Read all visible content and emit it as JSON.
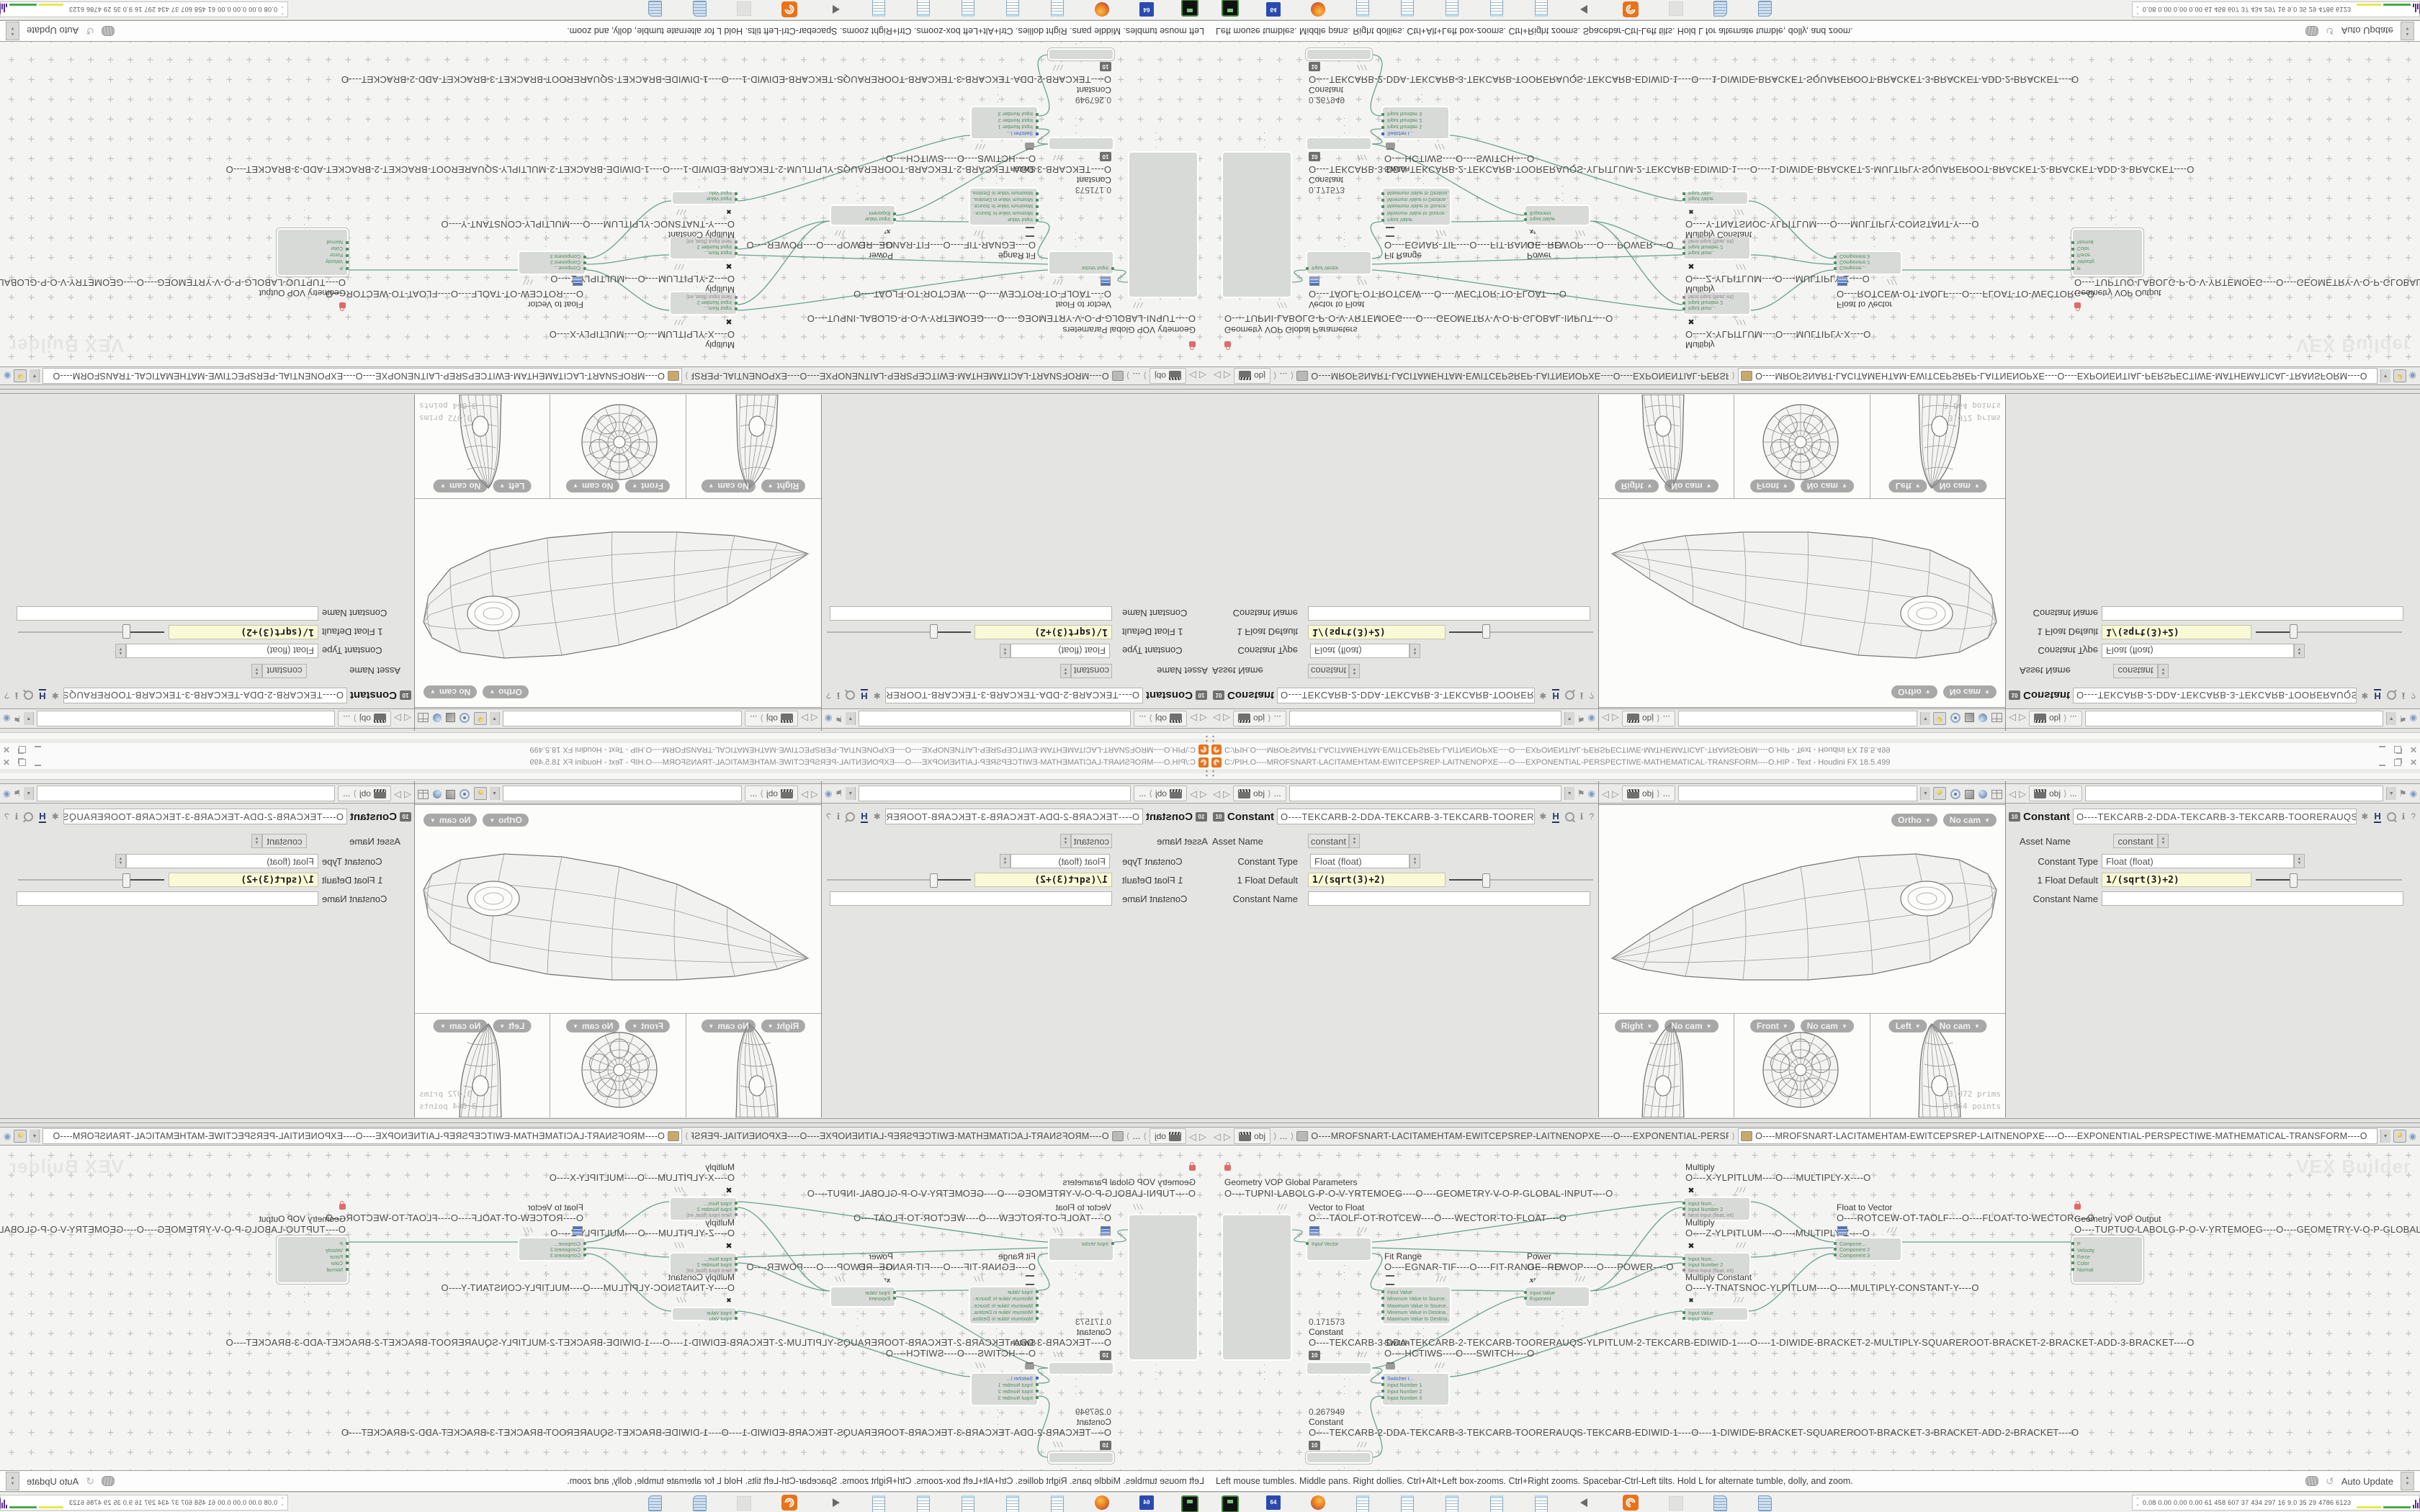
{
  "app": {
    "title": "C:/PIH.O----MROFSNART-LACITAMEHTAM-EWITCEPSREP-LAITNENOPXE----O----EXPONENTIAL-PERSPECTIWE-MATHEMATICAL-TRANSFORM----O.HIP - Text - Houdini FX 18.5.499",
    "accent_color": "#e8731a",
    "window_controls": [
      "minimize",
      "restore",
      "close"
    ]
  },
  "pane_bar": {
    "context": "obj",
    "ellipsis": "..."
  },
  "param_pane": {
    "type_label": "Constant",
    "node_name": "O----TEKCARB-2-DDA-TEKCARB-3-TEKCARB-TOORERAUQS-TEKCA",
    "rows": [
      {
        "label": "Asset Name",
        "value": "constant"
      },
      {
        "label": "Constant Type",
        "value": "Float (float)"
      },
      {
        "label": "1 Float Default",
        "value": "1/(sqrt(3)+2)"
      },
      {
        "label": "Constant Name",
        "value": ""
      }
    ]
  },
  "viewport": {
    "main_view": {
      "view": "Ortho",
      "camera": "No cam"
    },
    "small_views": [
      {
        "view": "Right",
        "camera": "No cam"
      },
      {
        "view": "Front",
        "camera": "No cam"
      },
      {
        "view": "Left",
        "camera": "No cam"
      }
    ],
    "stats": {
      "prims": "3,072 prims",
      "points": "3,064 points"
    }
  },
  "network": {
    "context_label": "obj",
    "context_name": "O----MROFSNART-LACITAMEHTAM-EWITCEPSREP-LAITNENOPXE----O----EXPONENTIAL-PERSPECTIWE-MATHEMATICAL-TRANSFORM----O",
    "watermark": "VEX Builder",
    "wire_color": "#68a18c",
    "port_colors": {
      "g": "#4e8f5e",
      "b": "#3a62c8",
      "n": "#9a7a42",
      "x": "#8a8a8a"
    },
    "nodes": [
      {
        "id": "globalparams",
        "stack": "tall",
        "lock": true,
        "label": "Geometry VOP Global Parameters",
        "name": "O----TUPNI-LABOLG-P-O-V-YRTEMOEG----O----GEOMETRY-V-O-P-GLOBAL-INPUT----O",
        "box": [
          18,
          97,
          94,
          200
        ],
        "ps": 20,
        "pstep": 8.3,
        "outputs": [
          [
            "P",
            "g"
          ],
          [
            "Velocity",
            "g"
          ],
          [
            "Force",
            "g"
          ],
          [
            "Age",
            "g"
          ],
          [
            "Life",
            "g"
          ],
          [
            "Id",
            "b"
          ],
          [
            "Cd",
            "g"
          ],
          [
            "UV",
            "g"
          ],
          [
            "N",
            "g"
          ],
          [
            "Time",
            "g"
          ],
          [
            "Time Inc",
            "g"
          ],
          [
            "Frame",
            "g"
          ],
          [
            "Point Number",
            "g"
          ],
          [
            "Primitive Number",
            "g"
          ],
          [
            "Vertex Number",
            "g"
          ],
          [
            "Number of Points",
            "g"
          ],
          [
            "Number of Prims",
            "g"
          ],
          [
            "Number of Vertices",
            "g"
          ],
          [
            "First Input",
            "n"
          ],
          [
            "Second Input",
            "n"
          ],
          [
            "Third Input",
            "n"
          ],
          [
            "Fourth Input",
            "n"
          ]
        ]
      },
      {
        "id": "vectofloat",
        "icon": "vec",
        "label": "Vector to Float",
        "name": "O----TAOLF-OT-ROTCEW----O----WECTOR-TO-FLOAT----O",
        "box": [
          135,
          129,
          88,
          30
        ],
        "ps": 5,
        "pstep": 8,
        "inputs": [
          [
            "Input Vector",
            "g"
          ]
        ],
        "outputs": [
          [
            "Compone...",
            "g"
          ],
          [
            "Component 2",
            "g"
          ],
          [
            "Component 3",
            "g"
          ]
        ]
      },
      {
        "id": "fitrange",
        "icon": "fit",
        "label": "Fit Range",
        "name": "O----EGNAR-TIF----O----FIT-RANGE----O",
        "box": [
          240,
          197,
          93,
          50
        ],
        "ps": 4,
        "pstep": 9.3,
        "inputs": [
          [
            "Input Value",
            "g"
          ],
          [
            "Minimum Value In Source..",
            "g"
          ],
          [
            "Maximum Value In Source..",
            "g"
          ],
          [
            "Minimum Value in Destina..",
            "g"
          ],
          [
            "Maximum Value In Destina..",
            "g"
          ]
        ],
        "outputs": [
          [
            "Shifted Value",
            "g"
          ]
        ]
      },
      {
        "id": "power",
        "icon": "pow",
        "label": "Power",
        "name": "O----REWOP----O----POWER----O",
        "box": [
          438,
          197,
          88,
          26
        ],
        "ps": 5,
        "pstep": 8,
        "inputs": [
          [
            "Input Value",
            "g"
          ],
          [
            "Exponent",
            "g"
          ]
        ],
        "outputs": [
          [
            "Output Value",
            "g"
          ]
        ]
      },
      {
        "id": "multiplyx",
        "icon": "mul",
        "label": "Multiply",
        "name": "O----X-YLPITLUM----O----MULTIPLY-X----O",
        "box": [
          658,
          73,
          91,
          30
        ],
        "ps": 5,
        "pstep": 8,
        "inputs": [
          [
            "Input Num...",
            "g"
          ],
          [
            "Input Number 2",
            "g"
          ],
          [
            "Next Input (float, int)",
            "x"
          ]
        ],
        "outputs": [
          [
            "Combined...",
            "g"
          ]
        ]
      },
      {
        "id": "multiplyz",
        "icon": "mul",
        "label": "Multiply",
        "name": "O----Z-YLPITLUM----O----MULTIPLY-Z----O",
        "box": [
          658,
          150,
          91,
          30
        ],
        "ps": 5,
        "pstep": 8,
        "inputs": [
          [
            "Input Num...",
            "g"
          ],
          [
            "Input Number 2",
            "g"
          ],
          [
            "Next Input (float, int)",
            "x"
          ]
        ],
        "outputs": [
          [
            "Combined...",
            "g"
          ]
        ]
      },
      {
        "id": "multiplyconstant",
        "icon": "mulc",
        "label": "Multiply Constant",
        "name": "O----Y-TNATSNOC-YLPITLUM----O----MULTIPLY-CONSTANT-Y----O",
        "box": [
          658,
          226,
          88,
          16
        ],
        "ps": 4,
        "pstep": 7.5,
        "inputs": [
          [
            "Input Value",
            "g"
          ],
          [
            "Input Valu...",
            "g"
          ]
        ],
        "outputs": [
          [
            "",
            "g"
          ]
        ]
      },
      {
        "id": "floattovec",
        "icon": "vec",
        "label": "Float to Vector",
        "name": "O----ROTCEW-OT-TAOLF----O----FLOAT-TO-WECTOR----O",
        "box": [
          868,
          129,
          91,
          30
        ],
        "ps": 5,
        "pstep": 8,
        "inputs": [
          [
            "Compone...",
            "g"
          ],
          [
            "Component 2",
            "g"
          ],
          [
            "Component 3",
            "g"
          ]
        ],
        "outputs": [
          [
            "Output Ve...",
            "g"
          ]
        ]
      },
      {
        "id": "globaloutput",
        "stack": "compact",
        "lock": true,
        "label": "Geometry VOP Output",
        "name": "O----TUPTUO-LABOLG-P-O-V-YRTEMOEG----O----GEOMETRY-V-O-P-GLOBAL-OUTPUT----O",
        "box": [
          1198,
          127,
          96,
          63
        ],
        "ps": 7,
        "pstep": 9,
        "sel": true,
        "inputs": [
          [
            "P",
            "g"
          ],
          [
            "Velocity",
            "g"
          ],
          [
            "Force",
            "g"
          ],
          [
            "Color",
            "g"
          ],
          [
            "Normal",
            "g"
          ]
        ]
      },
      {
        "id": "constant1",
        "icon": "c10",
        "label": "Constant",
        "value": "0.171573",
        "name": "O----TEKCARB-3-DDA-TEKCARB-2-TEKCARB-TOORERAUQS-YLPITLUM-2-TEKCARB-EDIWID-1----O----1-DIWIDE-BRACKET-2-MULTIPLY-SQUAREROOT-BRACKET-2-BRACKET-ADD-3-BRACKET----O",
        "box": [
          135,
          302,
          88,
          15
        ],
        "ps": 4,
        "pstep": 8,
        "outvalue": ": 0.171573"
      },
      {
        "id": "switch",
        "icon": "sw",
        "label": "Switch",
        "name": "O----HCTIWS----O----SWITCH----O",
        "box": [
          240,
          317,
          91,
          43
        ],
        "ps": 4,
        "pstep": 9,
        "inputs": [
          [
            "Switcher I...",
            "b"
          ],
          [
            "Input Number 1",
            "g"
          ],
          [
            "Input Number 2",
            "g"
          ],
          [
            "Input Number 3",
            "g"
          ]
        ],
        "outputs": [
          [
            "Chosen Val...",
            "g"
          ]
        ]
      },
      {
        "id": "constant2",
        "icon": "c10",
        "label": "Constant",
        "value": "0.267949",
        "sel": true,
        "name": "O----TEKCARB-2-DDA-TEKCARB-3-TEKCARB-TOORERAUQS-TEKCARB-EDIWID-1----O----1-DIWIDE-BRACKET-SQUAREROOT-BRACKET-3-BRACKET-ADD-2-BRACKET----O",
        "box": [
          135,
          427,
          88,
          13
        ],
        "ps": 3,
        "pstep": 8,
        "outvalue": ": 0.267949"
      }
    ],
    "wires": [
      [
        112,
        117,
        133,
        134
      ],
      [
        224,
        134,
        656,
        78
      ],
      [
        224,
        142,
        656,
        155
      ],
      [
        224,
        150,
        238,
        201
      ],
      [
        333,
        201,
        436,
        202
      ],
      [
        527,
        202,
        656,
        86
      ],
      [
        527,
        202,
        656,
        163
      ],
      [
        224,
        309,
        238,
        330
      ],
      [
        224,
        309,
        436,
        210
      ],
      [
        224,
        433,
        238,
        348
      ],
      [
        333,
        321,
        656,
        230
      ],
      [
        749,
        78,
        866,
        134
      ],
      [
        749,
        155,
        866,
        142
      ],
      [
        747,
        230,
        866,
        150
      ],
      [
        960,
        134,
        1196,
        134
      ]
    ]
  },
  "status": {
    "hint": "Left mouse tumbles. Middle pans. Right dollies. Ctrl+Alt+Left box-zooms. Ctrl+Right zooms. Spacebar-Ctrl-Left tilts. Hold L for alternate tumble, dolly, and zoom.",
    "cook_mode": "Auto Update"
  },
  "taskbar": {
    "app_icons": [
      "recorder",
      "floppy-64",
      "firefox",
      "notepad",
      "notepad",
      "notepad",
      "notepad",
      "notepad",
      "volume",
      "houdini",
      "ghost",
      "script",
      "script"
    ],
    "monitor_values": [
      "0.08",
      "0.00",
      "0.00",
      "0.00",
      "61",
      "458",
      "607",
      "37",
      "434",
      "297",
      "16",
      "9.0",
      "35",
      "29",
      "4786",
      "6123"
    ]
  }
}
